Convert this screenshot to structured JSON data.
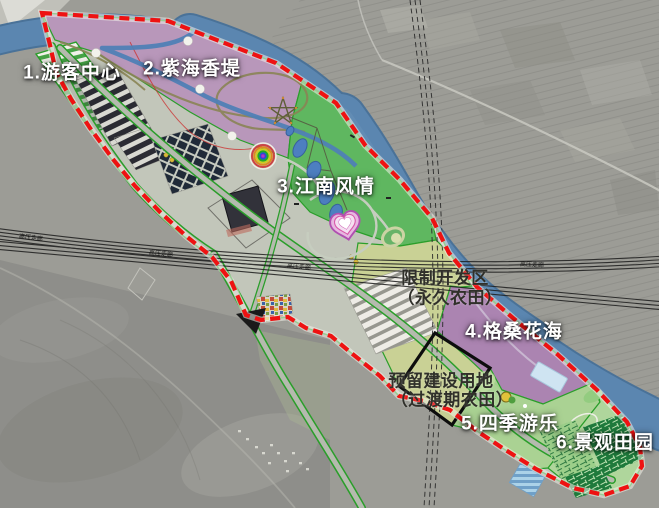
{
  "map": {
    "type": "tourism-agriculture-master-plan-on-satellite",
    "boundary_color": "#ee1212",
    "river_color": "#5b86b0",
    "farmland_color": "#c9d193",
    "road_edge_color": "#2a9e2a",
    "powerline_label": "高压走廊",
    "zones": [
      {
        "id": "1",
        "label": "1.游客中心",
        "color": "#eef0e8"
      },
      {
        "id": "2",
        "label": "2.紫海香堤",
        "color": "#b794ba"
      },
      {
        "id": "3",
        "label": "3.江南风情",
        "color": "#58b65a"
      },
      {
        "id": "4",
        "label": "4.格桑花海",
        "color": "#a97fb0"
      },
      {
        "id": "5",
        "label": "5.四季游乐",
        "color": "#a8d291"
      },
      {
        "id": "6",
        "label": "6.景观田园",
        "color": "#add79a"
      }
    ],
    "overlays": [
      {
        "name": "restricted-development-zone",
        "line1": "限制开发区",
        "line2": "（永久农田）"
      },
      {
        "name": "reserved-construction-land",
        "line1": "预留建设用地",
        "line2": "（过渡期农田）"
      }
    ]
  }
}
